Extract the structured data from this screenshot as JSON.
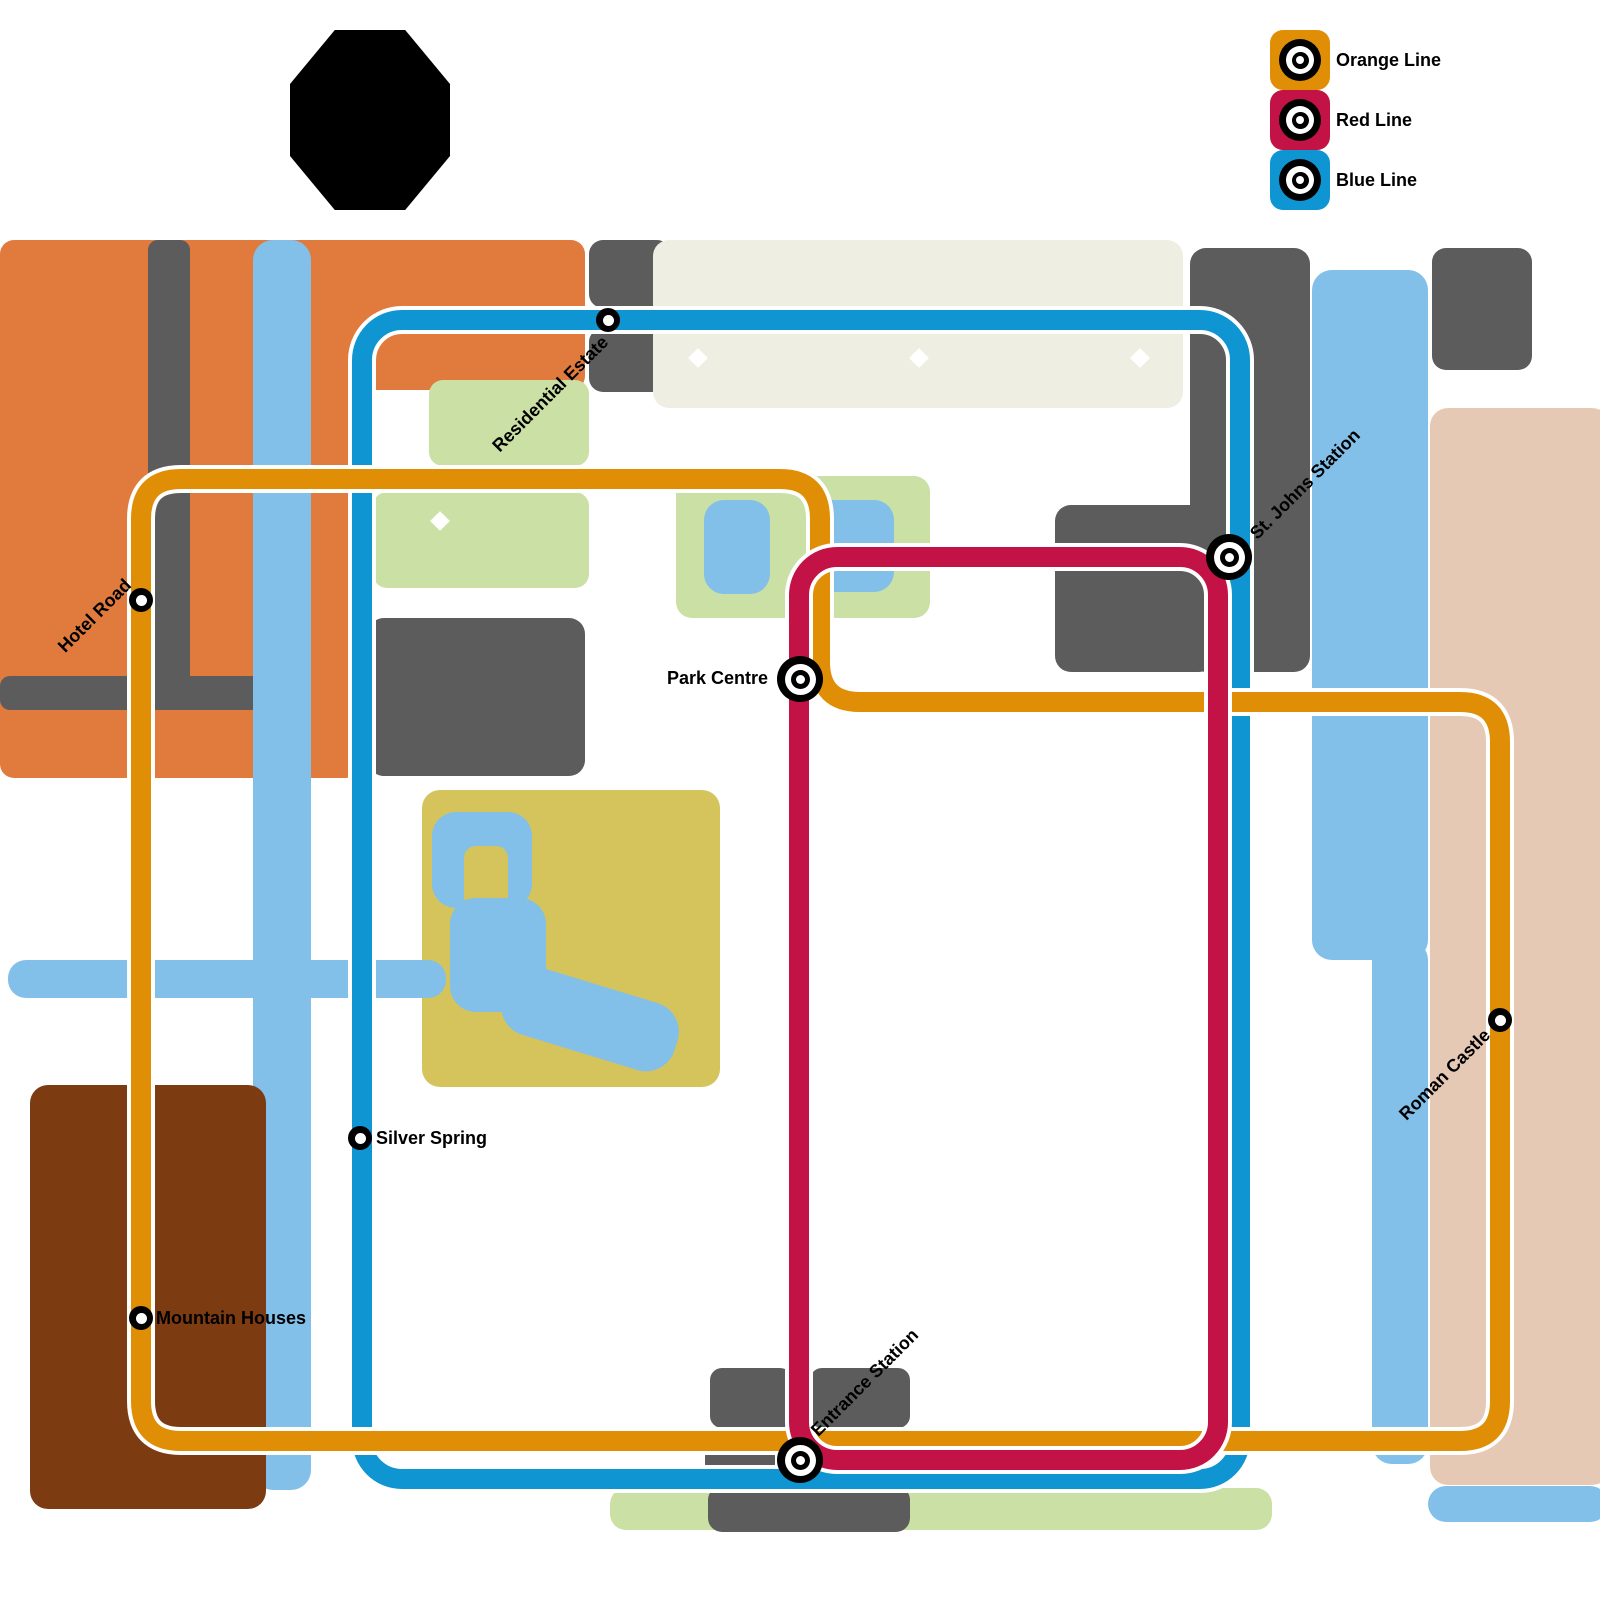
{
  "legend": {
    "items": [
      {
        "id": "orange",
        "label": "Orange Line",
        "color": "#DF8E05"
      },
      {
        "id": "red",
        "label": "Red Line",
        "color": "#C31245"
      },
      {
        "id": "blue",
        "label": "Blue Line",
        "color": "#1095D3"
      }
    ]
  },
  "lines": {
    "orange": {
      "name": "Orange Line",
      "color": "#DF8E05"
    },
    "red": {
      "name": "Red Line",
      "color": "#C31245"
    },
    "blue": {
      "name": "Blue Line",
      "color": "#1095D3"
    }
  },
  "stations": [
    {
      "id": "residential-estate",
      "name": "Residential Estate",
      "type": "regular",
      "lines": [
        "blue"
      ],
      "x": 608,
      "y": 320,
      "label": {
        "rotate": -45,
        "anchor": "end",
        "x": 605,
        "y": 339
      }
    },
    {
      "id": "hotel-road",
      "name": "Hotel Road",
      "type": "regular",
      "lines": [
        "orange"
      ],
      "x": 141,
      "y": 600,
      "label": {
        "rotate": -45,
        "anchor": "end",
        "x": 128,
        "y": 582
      }
    },
    {
      "id": "st-johns-station",
      "name": "St. Johns Station",
      "type": "interchange",
      "lines": [
        "red",
        "blue"
      ],
      "x": 1229,
      "y": 557,
      "label": {
        "rotate": -45,
        "anchor": "start",
        "x": 1253,
        "y": 536
      }
    },
    {
      "id": "park-centre",
      "name": "Park Centre",
      "type": "interchange",
      "lines": [
        "red",
        "orange"
      ],
      "x": 800,
      "y": 679,
      "label": {
        "rotate": 0,
        "anchor": "end",
        "x": 768,
        "y": 678
      }
    },
    {
      "id": "silver-spring",
      "name": "Silver Spring",
      "type": "regular",
      "lines": [
        "blue"
      ],
      "x": 360,
      "y": 1138,
      "label": {
        "rotate": 0,
        "anchor": "start",
        "x": 376,
        "y": 1138
      }
    },
    {
      "id": "mountain-houses",
      "name": "Mountain Houses",
      "type": "regular",
      "lines": [
        "orange"
      ],
      "x": 141,
      "y": 1318,
      "label": {
        "rotate": 0,
        "anchor": "start",
        "x": 156,
        "y": 1318
      }
    },
    {
      "id": "roman-castle",
      "name": "Roman Castle",
      "type": "regular",
      "lines": [
        "orange"
      ],
      "x": 1500,
      "y": 1020,
      "label": {
        "rotate": -45,
        "anchor": "end",
        "x": 1487,
        "y": 1032
      }
    },
    {
      "id": "entrance-station",
      "name": "Entrance Station",
      "type": "interchange",
      "lines": [
        "orange",
        "red",
        "blue"
      ],
      "x": 800,
      "y": 1460,
      "label": {
        "rotate": -45,
        "anchor": "start",
        "x": 814,
        "y": 1433
      }
    }
  ],
  "map_colors": {
    "district_orange": "#E07B3D",
    "building_gray": "#5C5C5C",
    "school_offwhite": "#EFEEE2",
    "park_lightgreen": "#CBE0A4",
    "park_yellow": "#D5C45C",
    "mountain_brown": "#7D3B12",
    "castle_pink": "#E6C9B4",
    "water_blue": "#82BFE9",
    "landmark_black": "#000000"
  }
}
